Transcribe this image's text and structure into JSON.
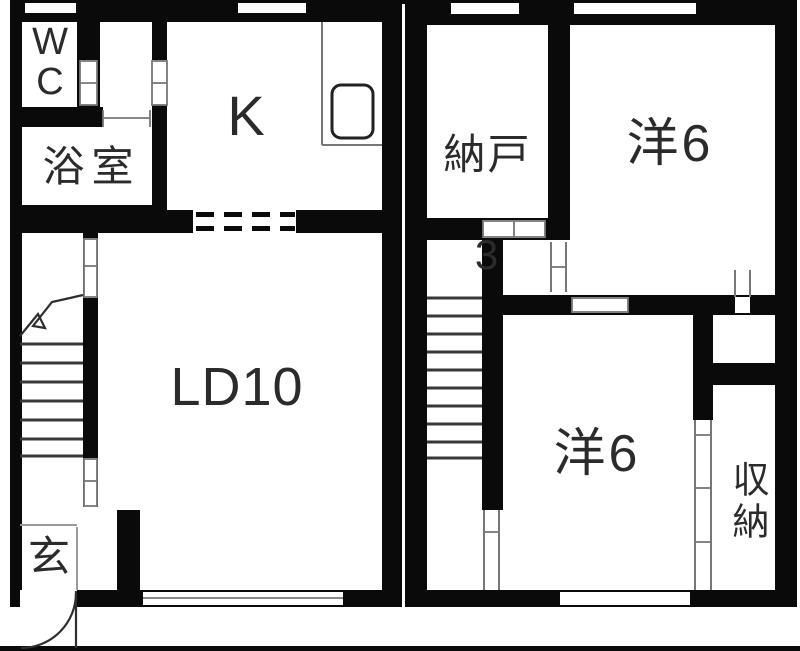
{
  "plan_type": "floorplan",
  "floor1": {
    "rooms": [
      {
        "id": "wc",
        "label": "WC"
      },
      {
        "id": "bathroom",
        "label": "浴室"
      },
      {
        "id": "kitchen",
        "label": "K"
      },
      {
        "id": "living-dining",
        "label": "LD10"
      },
      {
        "id": "entrance",
        "label": "玄"
      }
    ]
  },
  "floor2": {
    "rooms": [
      {
        "id": "storage-room",
        "label": "納戸",
        "size_label": "3"
      },
      {
        "id": "western-room-upper",
        "label": "洋6"
      },
      {
        "id": "western-room-lower",
        "label": "洋6"
      },
      {
        "id": "closet",
        "label": "収納"
      }
    ]
  },
  "colors": {
    "wall": "#0a0a0a",
    "background": "#ffffff",
    "detail_line": "#777777",
    "text": "#2b2b2b"
  }
}
